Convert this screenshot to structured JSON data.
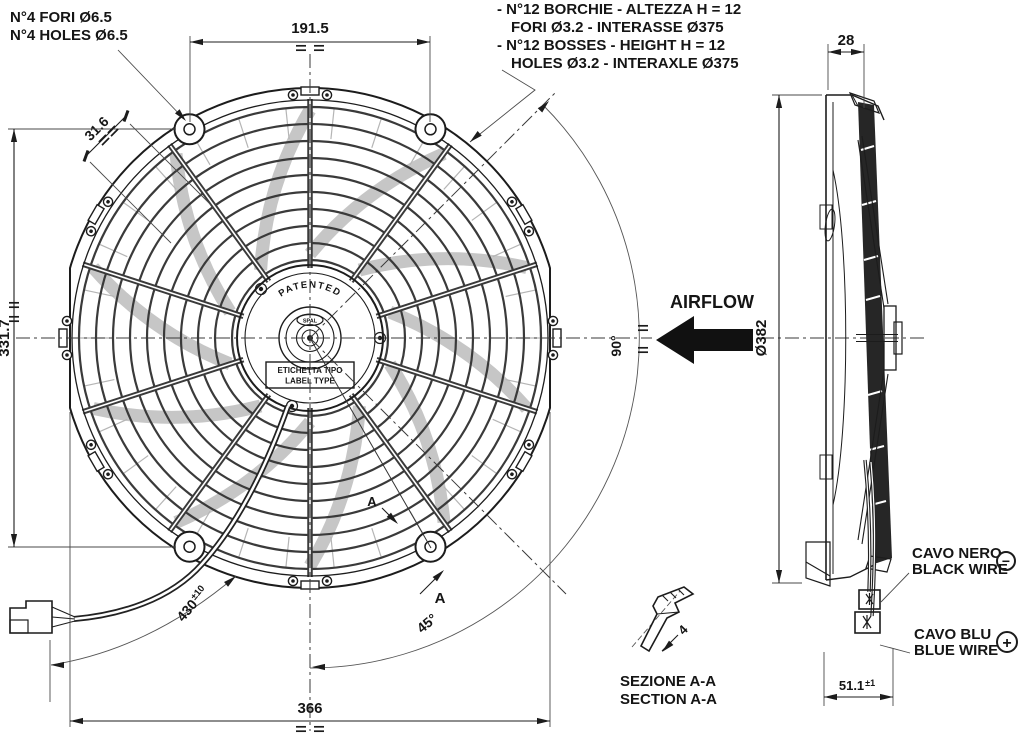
{
  "drawing": {
    "notes": {
      "mount_holes": [
        "N°4 FORI Ø6.5",
        "N°4 HOLES Ø6.5"
      ],
      "bosses": [
        "- N°12 BORCHIE - ALTEZZA H = 12",
        "FORI Ø3.2 - INTERASSE Ø375",
        "- N°12 BOSSES - HEIGHT H = 12",
        "HOLES Ø3.2 - INTERAXLE Ø375"
      ]
    },
    "dims": {
      "top_ear_spacing": "191.5",
      "boss_offset": "31.6",
      "ear_vertical_spacing": "331.7",
      "frame_width": "366",
      "wire_length": "430",
      "wire_length_tol": "±10",
      "depth": "28",
      "shroud_diameter": "Ø382",
      "terminal_offset": "51.1",
      "terminal_offset_tol": "±1",
      "sweep_angle": "90°",
      "half_sweep_angle": "45°",
      "bracket_thickness": "4"
    },
    "labels": {
      "airflow": "AIRFLOW",
      "patented": "PATENTED",
      "hub_logo": "SPAL",
      "label_box": [
        "ETICHETTA TIPO",
        "LABEL TYPE"
      ],
      "section_marker": "A",
      "section_title": [
        "SEZIONE A-A",
        "SECTION A-A"
      ],
      "black_wire": [
        "CAVO NERO",
        "BLACK WIRE"
      ],
      "black_wire_polarity": "−",
      "blue_wire": [
        "CAVO BLU",
        "BLUE WIRE"
      ],
      "blue_wire_polarity": "+"
    },
    "colors": {
      "line": "#1c1c1c",
      "blade_dark": "#262626",
      "blade_light": "#c6c6c6",
      "background": "#ffffff"
    }
  }
}
